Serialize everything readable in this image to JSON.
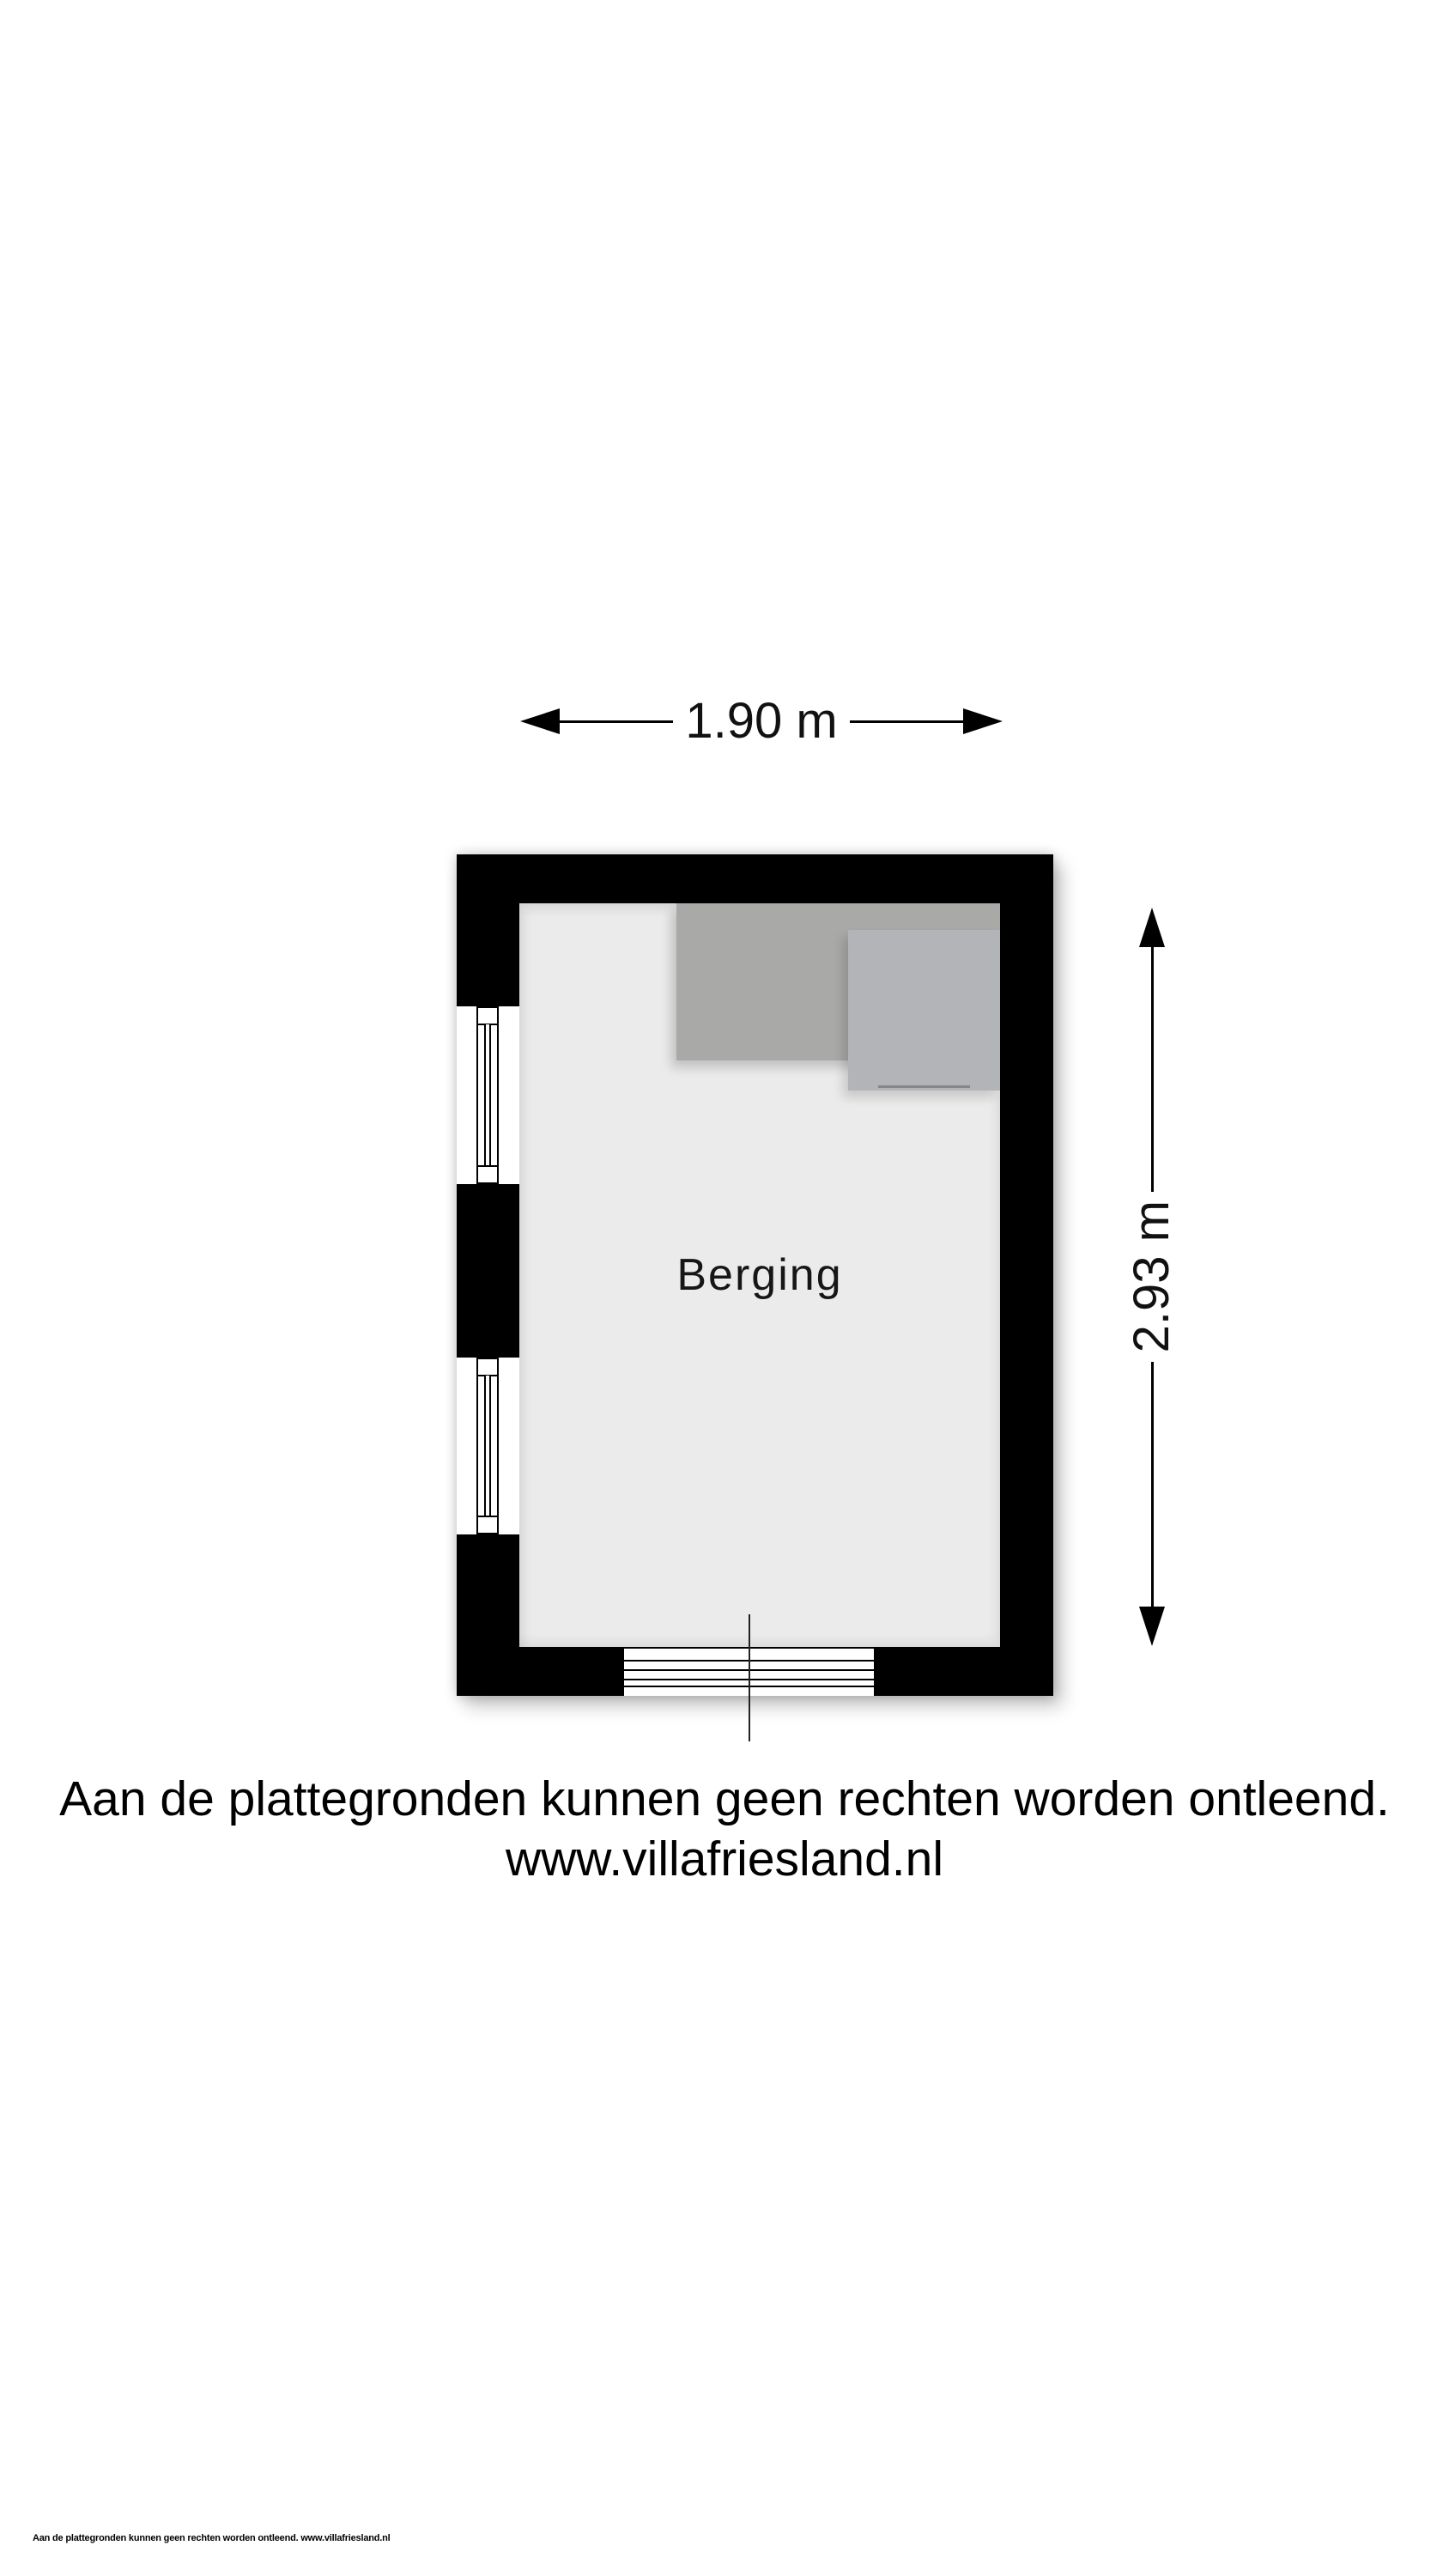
{
  "floor_plan": {
    "room_label": "Berging",
    "fixtures": [
      {
        "name": "counter",
        "color": "#a9a9a8"
      },
      {
        "name": "appliance",
        "color": "#b2b4b8"
      }
    ],
    "window_count": 2,
    "colors": {
      "wall": "#000000",
      "floor": "#ebebeb",
      "counter": "#a9a9a8",
      "appliance": "#b2b4b8",
      "background": "#ffffff"
    }
  },
  "dimensions": {
    "width_label": "1.90 m",
    "height_label": "2.93 m"
  },
  "disclaimer": {
    "line1": "Aan de plattegronden kunnen geen rechten worden ontleend.",
    "line2": "www.villafriesland.nl"
  },
  "footer": {
    "text": "Aan de plattegronden kunnen geen rechten worden ontleend. www.villafriesland.nl"
  },
  "icons": {
    "dimension_arrowheads": "black-triangle"
  }
}
